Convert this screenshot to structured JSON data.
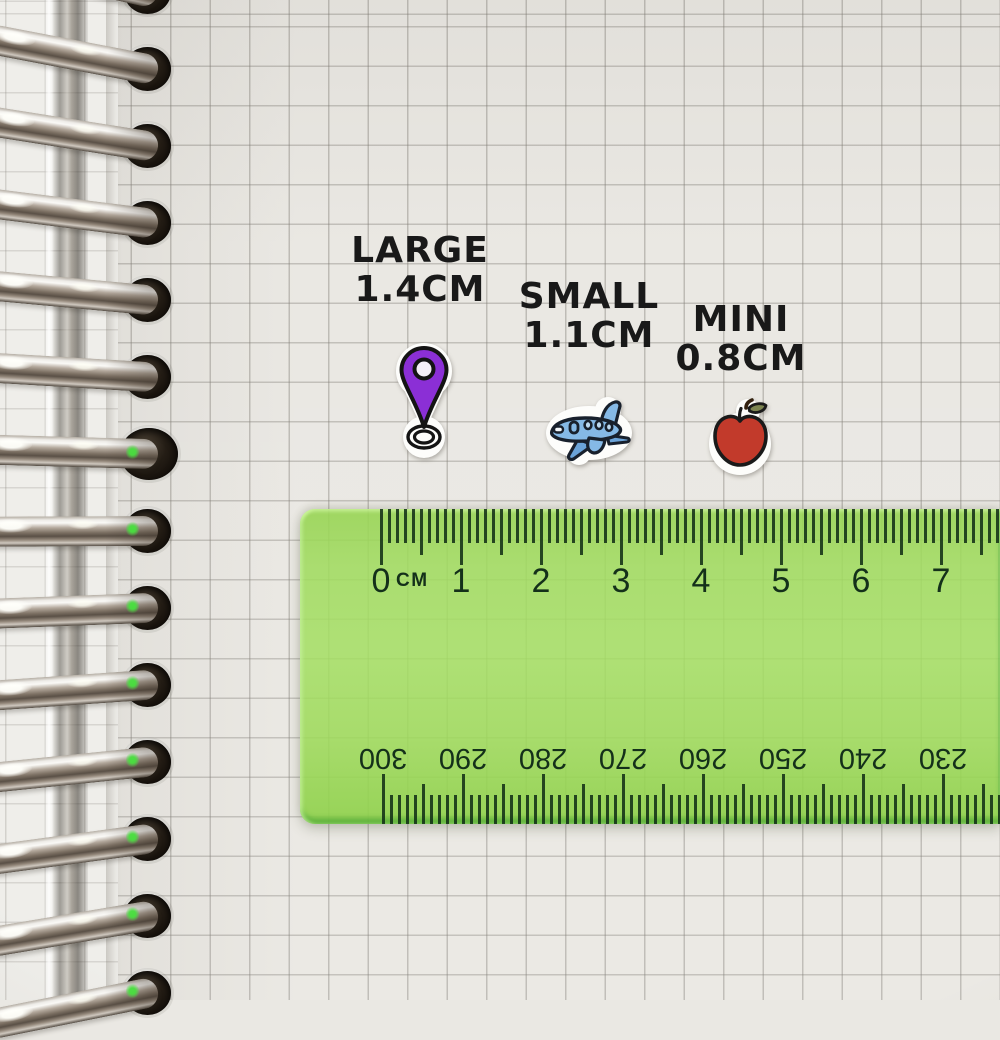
{
  "labels": [
    {
      "name": "LARGE",
      "size": "1.4CM"
    },
    {
      "name": "SMALL",
      "size": "1.1CM"
    },
    {
      "name": "MINI",
      "size": "0.8CM"
    }
  ],
  "stickers": [
    {
      "name": "location-pin",
      "label_ref": "LARGE 1.4CM"
    },
    {
      "name": "airplane",
      "label_ref": "SMALL 1.1CM"
    },
    {
      "name": "apple",
      "label_ref": "MINI 0.8CM"
    }
  ],
  "ruler": {
    "unit_label": "CM",
    "cm_numbers": [
      0,
      1,
      2,
      3,
      4,
      5,
      6,
      7
    ],
    "mm_numbers": [
      300,
      290,
      280,
      270,
      260,
      250,
      240,
      230
    ],
    "mm_numbers_orientation": "upside-down"
  },
  "notebook": {
    "paper_style": "grid",
    "visible_ring_count": 14
  },
  "colors": {
    "ruler_green": "#9ed95c",
    "ruler_markings": "#14301a",
    "paper": "#eae8e3",
    "grid_line": "#bdbab4",
    "label_text": "#191919",
    "pin_purple": "#8b2fd6",
    "plane_blue": "#85b9e6",
    "apple_red": "#c23a2b",
    "leaf_olive": "#7c8450",
    "ring_metal": "#b0a89d"
  }
}
